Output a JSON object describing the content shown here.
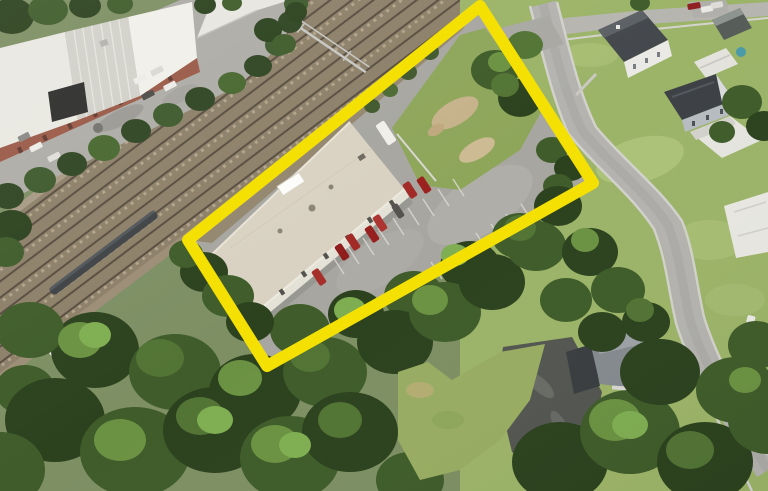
{
  "meta": {
    "width": 768,
    "height": 491,
    "content": "aerial-satellite-photo-with-property-highlight"
  },
  "highlight": {
    "shape": "rotated-rectangle-outline",
    "points": "480,6 593,183 267,366 188,240",
    "color": "#F4E103",
    "stroke_width": 12
  },
  "scene": {
    "features": [
      "railroad-corridor",
      "freight-train",
      "catenary-gantry",
      "industrial-complex",
      "warehouse-building",
      "parking-lot",
      "vacant-grass-lot",
      "tree-canopy",
      "residential-neighborhood",
      "streets"
    ],
    "red_cars_in_lot": 7
  },
  "palette": {
    "highlight_yellow": "#F4E103",
    "railroad_bed": "#8d8069",
    "rail_dark": "#584e40",
    "asphalt_lot": "#a7a6a1",
    "road_gray": "#b4b3af",
    "industrial_pavement": "#aeaca6",
    "industrial_roof_white": "#e9e8e1",
    "brick_wall": "#9b5a47",
    "warehouse_roof": "#d9d2c2",
    "vacant_lot_grass": "#8ea65a",
    "lawn_green": "#9cb468",
    "tree_dark": "#2c421e",
    "tree_mid": "#3f5c2a",
    "tree_light": "#527434",
    "red_car": "#a32a26",
    "house_roof_dark": "#44484c",
    "driveway_dark": "#545651"
  }
}
